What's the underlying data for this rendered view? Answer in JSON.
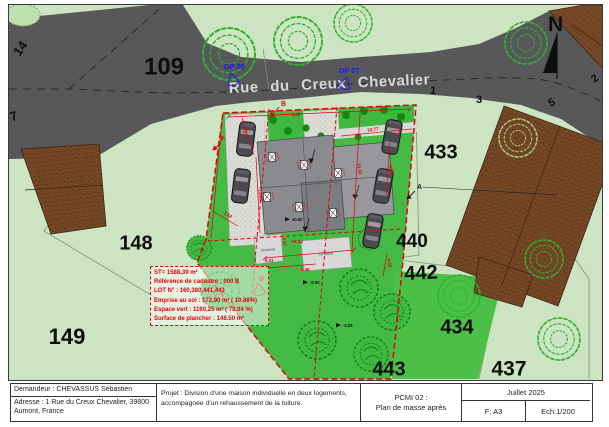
{
  "colors": {
    "paper": "#ffffff",
    "land": "#cde4c3",
    "road": "#58585a",
    "garden_green": "#44b944",
    "roof_gray": "#8a8b8f",
    "neighbor_roof_brown": "#7a4a28",
    "boundary_red": "#e3000f",
    "marker_blue": "#1a1aee"
  },
  "street": {
    "name": "Rue du Creux Chevalier"
  },
  "north_label": "N",
  "dp_markers": {
    "dp08": "DP 08",
    "dp07": "DP 07"
  },
  "parcel_labels": {
    "p14": "14",
    "p7": "7",
    "p109": "109",
    "p433": "433",
    "p148": "148",
    "p149": "149",
    "p440": "440",
    "p442": "442",
    "p434": "434",
    "p443": "443",
    "p437": "437"
  },
  "road_numbers": {
    "n1": "1",
    "n3": "3",
    "n5": "5",
    "n2": "2"
  },
  "section_markers": {
    "a_left": "A",
    "a_right": "A",
    "b_top": "B",
    "b_bottom": "B"
  },
  "terrace": {
    "label1": "Terrasse",
    "label2": "Terrasse"
  },
  "dimensions": [
    "9.60",
    "10.77",
    "4.91",
    "11.50",
    "14.50",
    "4.88",
    "44.34",
    "4.57",
    "9.31",
    "5.48",
    "4.03",
    "3.54"
  ],
  "elevations": [
    "±0.00",
    "-0.05",
    "-0.05"
  ],
  "stats_box": {
    "line1": "ST= 1588,39 m²",
    "line2": "Référence de cadastre : 000 B",
    "line3": "LOT N° : 160,380,441,443",
    "line4": "Emprise au sol : 172,90 m² ( 10.88%)",
    "line5": "Espace vert : 1160,25 m² ( 73.04 %)",
    "line6": "Surface de plancher : 148.50 m²"
  },
  "title_block": {
    "demandeur": "Demandeur : CHEVASSUS Sébastien",
    "adresse": "Adresse :  1 Rue du Creux Chevalier, 39800 Aumont, France",
    "projet_line1": "Projet  :  Division d'une maison individuelle en deux logements,",
    "projet_line2": "accompagnée d'un rehaussement de la toiture.",
    "piece_ref": "PCMI 02 :",
    "piece_name": "Plan de masse après",
    "date": "Juillet  2025",
    "format": "F: A3",
    "echelle": "Ech:1/200"
  }
}
